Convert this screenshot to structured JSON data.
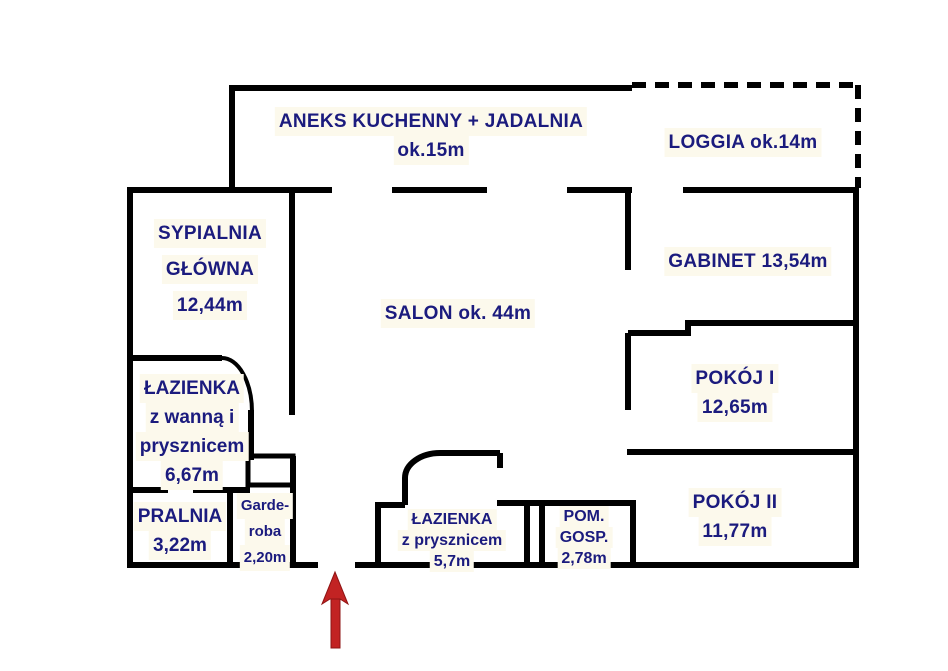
{
  "plan": {
    "colors": {
      "wall": "#000000",
      "text": "#1b1b7e",
      "arrow": "#c22323"
    },
    "rooms": {
      "kitchen": {
        "name": "ANEKS KUCHENNY + JADALNIA",
        "area": "ok.15m"
      },
      "loggia": {
        "label": "LOGGIA ok.14m"
      },
      "bedroom": {
        "line1": "SYPIALNIA",
        "line2": "GŁÓWNA",
        "area": "12,44m"
      },
      "salon": {
        "label": "SALON ok. 44m"
      },
      "gabinet": {
        "label": "GABINET 13,54m"
      },
      "pokoj1": {
        "name": "POKÓJ I",
        "area": "12,65m"
      },
      "pokoj2": {
        "name": "POKÓJ II",
        "area": "11,77m"
      },
      "bathroom1": {
        "line1": "ŁAZIENKA",
        "line2": "z wanną i",
        "line3": "prysznicem",
        "area": "6,67m"
      },
      "pralnia": {
        "name": "PRALNIA",
        "area": "3,22m"
      },
      "garderoba": {
        "line1": "Garde-",
        "line2": "roba",
        "area": "2,20m"
      },
      "bathroom2": {
        "line1": "ŁAZIENKA",
        "line2": "z prysznicem",
        "area": "5,7m"
      },
      "pomgosp": {
        "line1": "POM.",
        "line2": "GOSP.",
        "area": "2,78m"
      }
    }
  }
}
